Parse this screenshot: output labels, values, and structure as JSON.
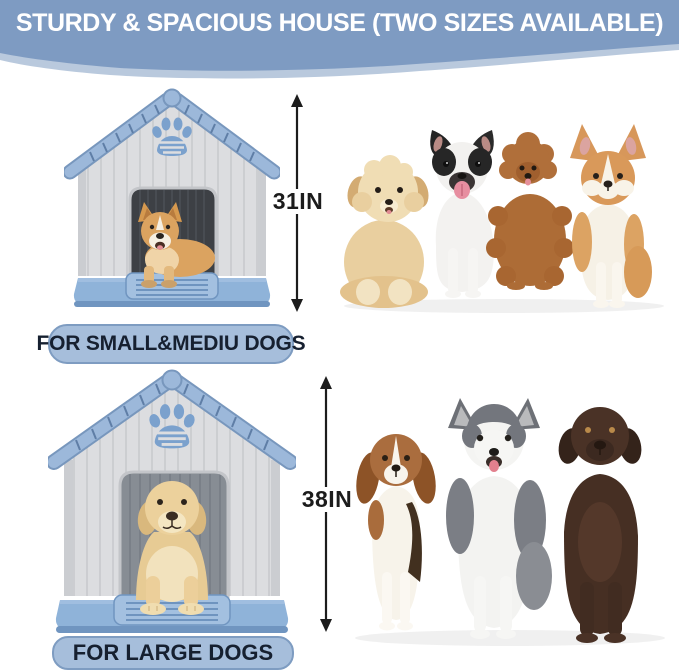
{
  "banner": {
    "title": "STURDY & SPACIOUS HOUSE (TWO SIZES AVAILABLE)"
  },
  "sections": [
    {
      "size_label": "FOR SMALL&MEDIU DOGS",
      "height_label": "31IN",
      "house_illustration": "dog-house-with-corgi-icon",
      "dogs": [
        "havanese-puppy",
        "french-bulldog",
        "toy-poodle",
        "welsh-corgi"
      ]
    },
    {
      "size_label": "FOR LARGE DOGS",
      "height_label": "38IN",
      "house_illustration": "dog-house-with-labrador-icon",
      "dogs": [
        "beagle",
        "siberian-husky",
        "chocolate-labrador"
      ]
    }
  ],
  "colors": {
    "banner_blue": "#7e9bc2",
    "wave_light": "#b9c9dd",
    "pill_bg": "#a6bedb",
    "pill_border": "#7e9cc1",
    "pill_text": "#162030",
    "arrow_black": "#1c1c1c",
    "wall_gray": "#dcdde0",
    "wall_line": "#c6c8cc",
    "wall_side": "#cbcdd1",
    "roof_blue": "#9cb8da",
    "roof_edge": "#7897bd",
    "roof_tick": "#5f7ea6",
    "paw_blue": "#7ba1cd",
    "door_dark": "#3d4045",
    "door_light": "#878d94",
    "door_plank": "#4c5157",
    "door_frame": "#c3c5c9",
    "base_blue": "#8fb3d9",
    "base_dark": "#7095c0",
    "step_blue": "#a3c0e0",
    "groove_blue": "#6f94bf"
  }
}
